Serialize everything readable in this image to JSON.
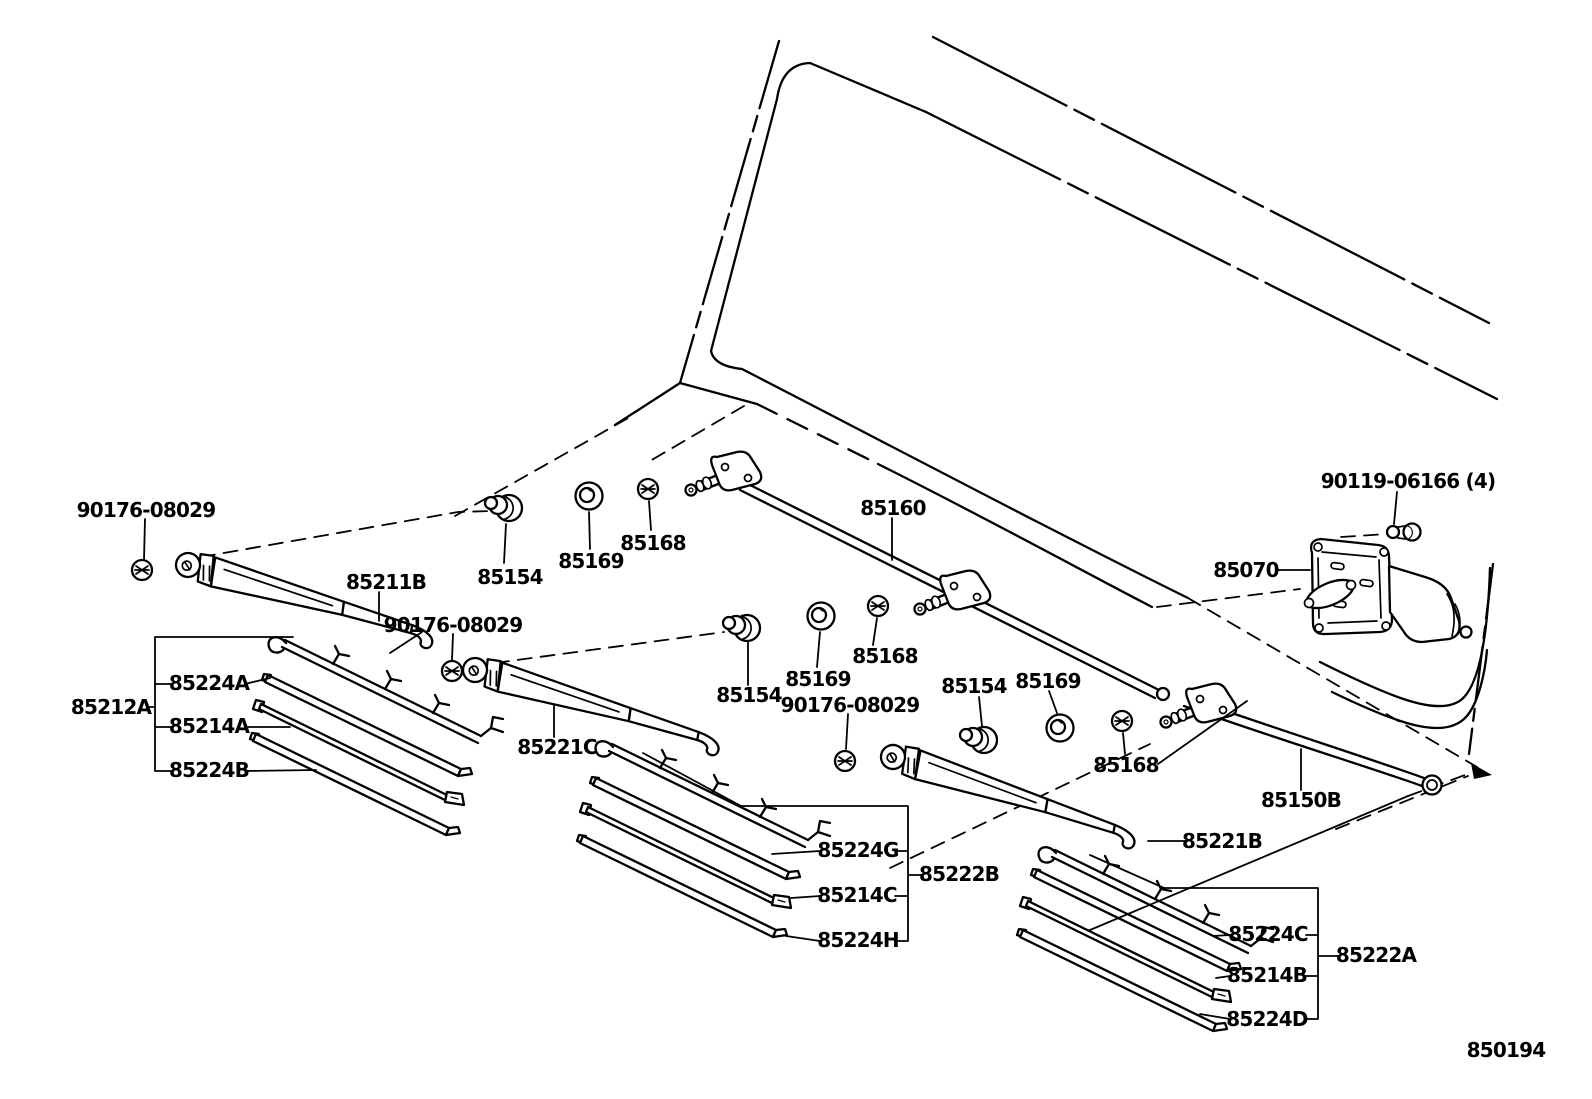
{
  "diagram": {
    "title_code": "850194",
    "type": "parts-diagram",
    "subject": "rear wiper and washer linkage exploded view",
    "colors": {
      "line": "#000000",
      "background": "#ffffff"
    }
  },
  "labels": {
    "pn_90176_08029_a": "90176-08029",
    "pn_90176_08029_b": "90176-08029",
    "pn_90176_08029_c": "90176-08029",
    "pn_85211b": "85211B",
    "pn_85154_a": "85154",
    "pn_85154_b": "85154",
    "pn_85154_c": "85154",
    "pn_85169_a": "85169",
    "pn_85169_b": "85169",
    "pn_85169_c": "85169",
    "pn_85168_a": "85168",
    "pn_85168_b": "85168",
    "pn_85168_c": "85168",
    "pn_85160": "85160",
    "pn_90119_06166": "90119-06166 (4)",
    "pn_85070": "85070",
    "pn_85150b": "85150B",
    "pn_85221b": "85221B",
    "pn_85221c": "85221C",
    "pn_85212a": "85212A",
    "pn_85224a": "85224A",
    "pn_85214a": "85214A",
    "pn_85224b": "85224B",
    "pn_85224g": "85224G",
    "pn_85222b": "85222B",
    "pn_85214c": "85214C",
    "pn_85224h": "85224H",
    "pn_85224c": "85224C",
    "pn_85222a": "85222A",
    "pn_85214b": "85214B",
    "pn_85224d": "85224D",
    "diagram_code": "850194"
  },
  "assemblies": [
    {
      "assembly": "85212A",
      "components": [
        "85224A",
        "85214A",
        "85224B"
      ]
    },
    {
      "assembly": "85222B",
      "components": [
        "85224G",
        "85214C",
        "85224H"
      ]
    },
    {
      "assembly": "85222A",
      "components": [
        "85224C",
        "85214B",
        "85224D"
      ]
    }
  ]
}
